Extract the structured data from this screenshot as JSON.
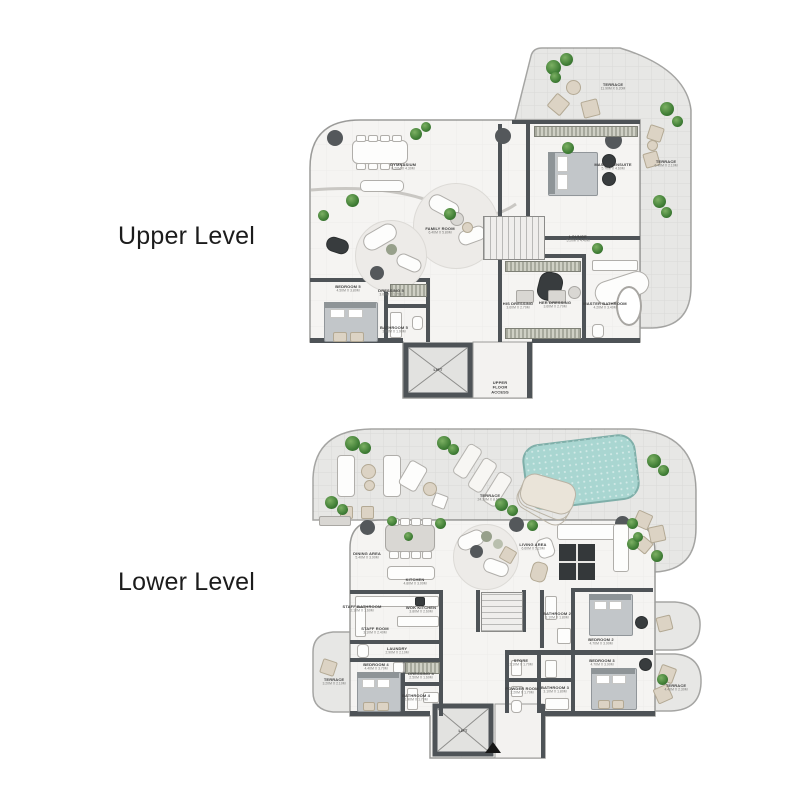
{
  "page": {
    "background": "#ffffff"
  },
  "colors": {
    "wall": "#4e5357",
    "interior_floor": "#f5f4f2",
    "terrace_floor": "#e7e7e5",
    "pool": "#a9d6d1",
    "plant_green": "#3f7d35",
    "furniture_beige": "#dcd3c4",
    "label_text": "#3e3e3e",
    "title_text": "#1c1c1c"
  },
  "upper": {
    "title": "Upper Level",
    "rooms": {
      "terrace_ne": {
        "name": "TERRACE",
        "dims": "11.90M X 6.20M"
      },
      "gym": {
        "name": "GYMNASIUM",
        "dims": "8.20M X 4.30M"
      },
      "family": {
        "name": "FAMILY ROOM",
        "dims": "6.40M X 5.80M"
      },
      "master": {
        "name": "MASTER ENSUITE",
        "dims": "5.70M X 4.60M"
      },
      "terrace_e": {
        "name": "TERRACE",
        "dims": "6.40M X 2.10M"
      },
      "lounge": {
        "name": "LOUNGE",
        "dims": "5.20M X 4.40M"
      },
      "bedroom5": {
        "name": "BEDROOM 5",
        "dims": "4.50M X 3.80M"
      },
      "dressing5": {
        "name": "DRESSING 5",
        "dims": "3.00M X 1.70M"
      },
      "bathroom5": {
        "name": "BATHROOM 5",
        "dims": "3.00M X 1.90M"
      },
      "his": {
        "name": "HIS DRESSING",
        "dims": "3.60M X 2.70M"
      },
      "her": {
        "name": "HER DRESSING",
        "dims": "3.60M X 2.70M"
      },
      "masterbath": {
        "name": "MASTER BATHROOM",
        "dims": "4.20M X 3.40M"
      },
      "lift": {
        "name": "LIFT"
      },
      "access": {
        "name": "UPPER FLOOR ACCESS"
      }
    }
  },
  "lower": {
    "title": "Lower Level",
    "rooms": {
      "terrace": {
        "name": "TERRACE",
        "dims": "24.30M X 8.60M"
      },
      "dining": {
        "name": "DINING AREA",
        "dims": "5.40M X 3.90M"
      },
      "kitchen": {
        "name": "KITCHEN",
        "dims": "4.80M X 3.00M"
      },
      "living": {
        "name": "LIVING AREA",
        "dims": "6.60M X 5.20M"
      },
      "staffbath": {
        "name": "STAFF BATHROOM",
        "dims": "2.10M X 1.60M"
      },
      "wok": {
        "name": "WOK KITCHEN",
        "dims": "3.80M X 2.60M"
      },
      "staff": {
        "name": "STAFF ROOM",
        "dims": "3.10M X 2.40M"
      },
      "laundry": {
        "name": "LAUNDRY",
        "dims": "2.90M X 2.10M"
      },
      "bedroom4": {
        "name": "BEDROOM 4",
        "dims": "4.40M X 3.70M"
      },
      "dressing4": {
        "name": "DRESSING 4",
        "dims": "2.50M X 1.60M"
      },
      "bathroom4": {
        "name": "BATHROOM 4",
        "dims": "2.90M X 1.70M"
      },
      "store": {
        "name": "STORE",
        "dims": "2.10M X 1.70M"
      },
      "powder": {
        "name": "POWDER ROOM",
        "dims": "2.20M X 1.70M"
      },
      "bathroom2": {
        "name": "BATHROOM 2",
        "dims": "3.10M X 1.80M"
      },
      "bedroom2": {
        "name": "BEDROOM 2",
        "dims": "4.70M X 3.90M"
      },
      "bathroom3": {
        "name": "BATHROOM 3",
        "dims": "3.10M X 1.80M"
      },
      "bedroom3": {
        "name": "BEDROOM 3",
        "dims": "4.70M X 3.90M"
      },
      "terrace_l": {
        "name": "TERRACE",
        "dims": "3.20M X 2.10M"
      },
      "terrace_r": {
        "name": "TERRACE",
        "dims": "4.40M X 2.30M"
      },
      "lift": {
        "name": "LIFT"
      }
    }
  }
}
